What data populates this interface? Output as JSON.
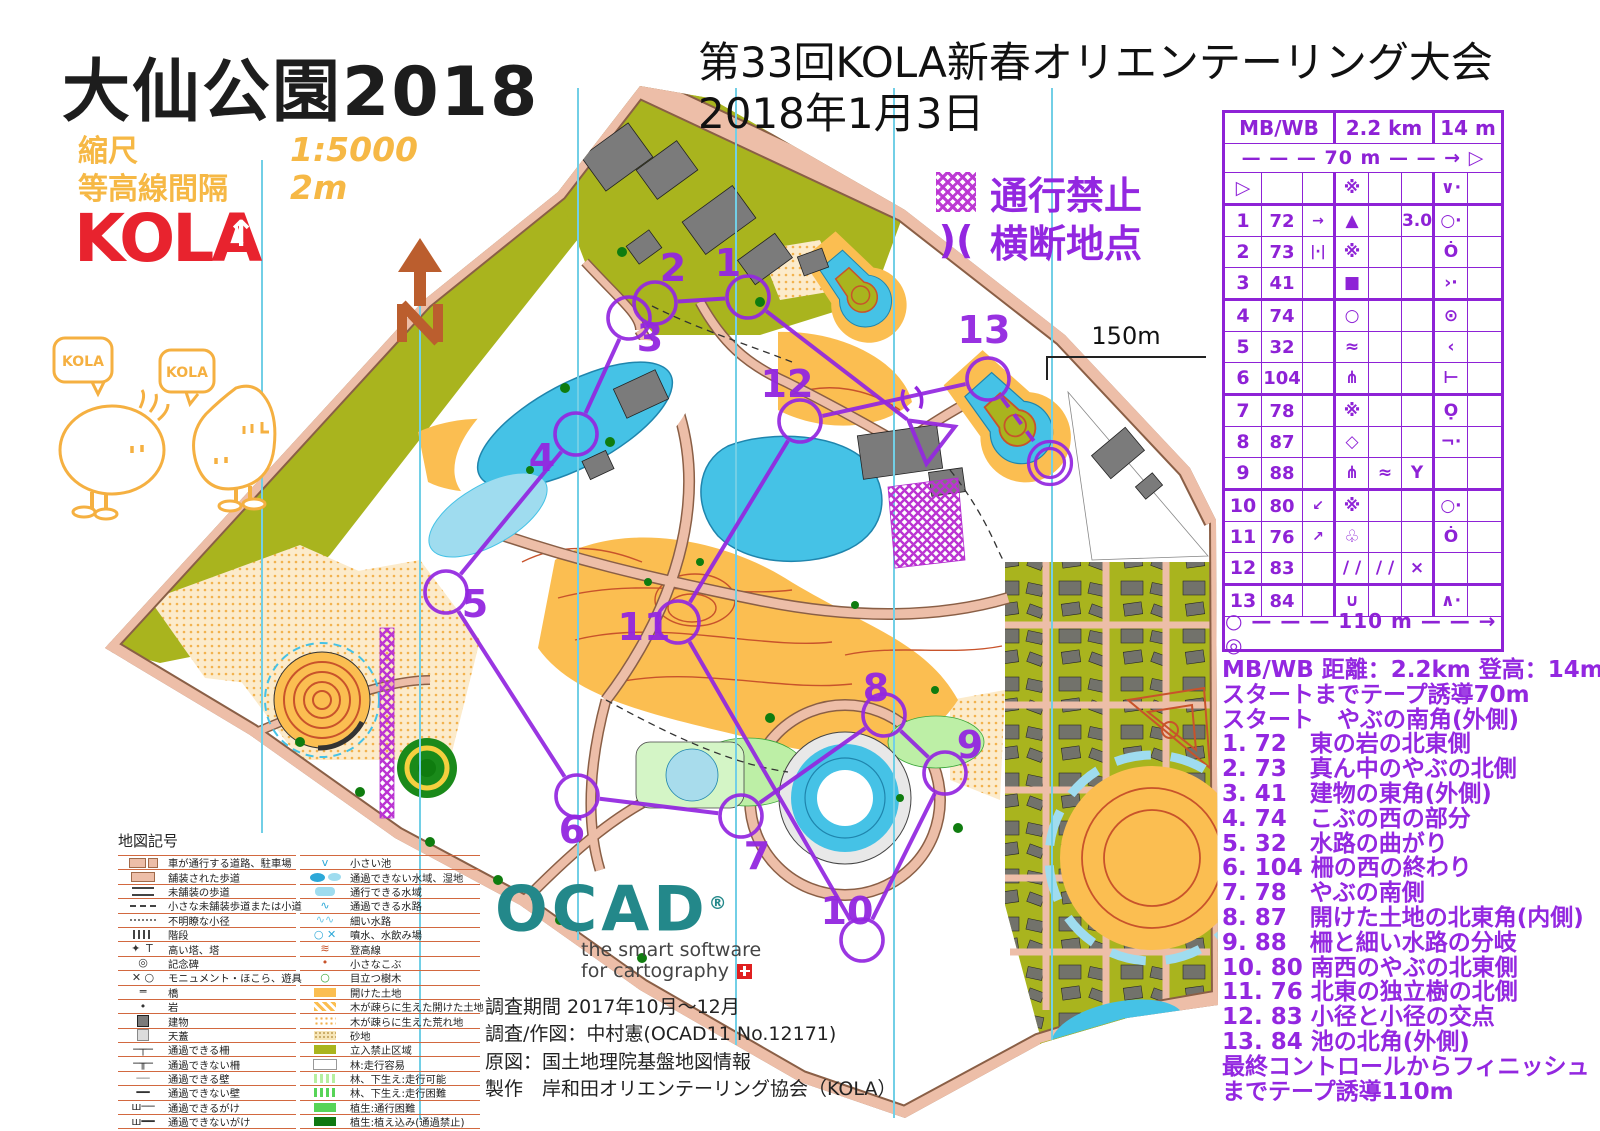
{
  "title_block": {
    "title": "大仙公園2018",
    "scale_label": "縮尺",
    "scale_value": "1:5000",
    "contour_label": "等高線間隔",
    "contour_value": "2m",
    "club": "KOLA"
  },
  "event": {
    "line1": "第33回KOLA新春オリエンテーリング大会",
    "line2": "2018年1月3日"
  },
  "overprint": {
    "forbidden_label": "通行禁止",
    "crossing_symbol": ")(",
    "crossing_label": "横断地点"
  },
  "mascots": {
    "left_bubble": "KOLA",
    "right_bubble": "KOLA"
  },
  "north_arrow": {
    "letter": "N"
  },
  "scale_bar": {
    "label": "150m"
  },
  "control_card": {
    "class_header": "MB/WB",
    "distance_header": "2.2 km",
    "climb_header": "14 m",
    "tape_to_start": "— — —  70 m  — — → ▷",
    "tape_to_finish": "○ — — —  110 m  — — → ◎",
    "start_row": {
      "a": "▷",
      "b": "",
      "c": "",
      "d": "※",
      "e": "",
      "f": "",
      "g": "∨·",
      "h": ""
    },
    "rows": [
      {
        "a": "1",
        "b": "72",
        "c": "→",
        "d": "▲",
        "e": "",
        "f": "3.0",
        "g": "○·",
        "h": ""
      },
      {
        "a": "2",
        "b": "73",
        "c": "|·|",
        "d": "※",
        "e": "",
        "f": "",
        "g": "Ȯ",
        "h": ""
      },
      {
        "a": "3",
        "b": "41",
        "c": "",
        "d": "■",
        "e": "",
        "f": "",
        "g": "›·",
        "h": ""
      },
      {
        "a": "4",
        "b": "74",
        "c": "",
        "d": "○",
        "e": "",
        "f": "",
        "g": "⊙",
        "h": ""
      },
      {
        "a": "5",
        "b": "32",
        "c": "",
        "d": "≈",
        "e": "",
        "f": "",
        "g": "‹",
        "h": ""
      },
      {
        "a": "6",
        "b": "104",
        "c": "",
        "d": "⋔",
        "e": "",
        "f": "",
        "g": "⊢",
        "h": ""
      },
      {
        "a": "7",
        "b": "78",
        "c": "",
        "d": "※",
        "e": "",
        "f": "",
        "g": "Ọ",
        "h": ""
      },
      {
        "a": "8",
        "b": "87",
        "c": "",
        "d": "◇",
        "e": "",
        "f": "",
        "g": "¬·",
        "h": ""
      },
      {
        "a": "9",
        "b": "88",
        "c": "",
        "d": "⋔",
        "e": "≈",
        "f": "Y",
        "g": "",
        "h": ""
      },
      {
        "a": "10",
        "b": "80",
        "c": "↙",
        "d": "※",
        "e": "",
        "f": "",
        "g": "○·",
        "h": ""
      },
      {
        "a": "11",
        "b": "76",
        "c": "↗",
        "d": "♧",
        "e": "",
        "f": "",
        "g": "Ȯ",
        "h": ""
      },
      {
        "a": "12",
        "b": "83",
        "c": "",
        "d": "∕ ∕",
        "e": "∕ ∕",
        "f": "×",
        "g": "",
        "h": ""
      },
      {
        "a": "13",
        "b": "84",
        "c": "",
        "d": "∪",
        "e": "",
        "f": "",
        "g": "∧·",
        "h": ""
      }
    ],
    "thick_after": [
      "▷",
      "3",
      "6",
      "9",
      "12"
    ]
  },
  "descriptions": {
    "lines": [
      "MB/WB 距離：2.2km 登高：14m",
      "スタートまでテープ誘導70m",
      "スタート　やぶの南角(外側)",
      "1. 72　東の岩の北東側",
      "2. 73　真ん中のやぶの北側",
      "3. 41　建物の東角(外側)",
      "4. 74　こぶの西の部分",
      "5. 32　水路の曲がり",
      "6. 104 柵の西の終わり",
      "7. 78　やぶの南側",
      "8. 87　開けた土地の北東角(内側)",
      "9. 88　柵と細い水路の分岐",
      "10. 80 南西のやぶの北東側",
      "11. 76 北東の独立樹の北側",
      "12. 83 小径と小径の交点",
      "13. 84 池の北角(外側)",
      "最終コントロールからフィニッシュ",
      "までテープ誘導110m"
    ]
  },
  "map_legend": {
    "title": "地図記号",
    "col1": [
      {
        "cls": "s-road",
        "label": "車が通行する道路、駐車場"
      },
      {
        "cls": "s-paved",
        "label": "舗装された歩道"
      },
      {
        "cls": "s-unpaved",
        "label": "未舗装の歩道"
      },
      {
        "cls": "s-smallpath",
        "label": "小さな未舗装歩道または小道"
      },
      {
        "cls": "s-indistinct",
        "label": "不明瞭な小径"
      },
      {
        "cls": "s-steps",
        "label": "階段"
      },
      {
        "cls": "glyph",
        "g": "✦ Ｔ",
        "label": "高い塔、塔"
      },
      {
        "cls": "glyph",
        "g": "◎",
        "label": "記念碑"
      },
      {
        "cls": "glyph",
        "g": "✕ ○",
        "label": "モニュメント・ほこら、遊具"
      },
      {
        "cls": "glyph",
        "g": "═",
        "label": "橋"
      },
      {
        "cls": "glyph",
        "g": "•",
        "label": "岩"
      },
      {
        "cls": "s-bld",
        "label": "建物"
      },
      {
        "cls": "s-canopy",
        "label": "天蓋"
      },
      {
        "cls": "glyph",
        "g": "─┬─",
        "label": "通過できる柵"
      },
      {
        "cls": "glyph",
        "g": "─╥─",
        "label": "通過できない柵"
      },
      {
        "cls": "glyph",
        "g": "──",
        "c": "#888",
        "label": "通過できる壁"
      },
      {
        "cls": "glyph",
        "g": "━━",
        "label": "通過できない壁"
      },
      {
        "cls": "glyph",
        "g": "ш──",
        "label": "通過できるがけ"
      },
      {
        "cls": "glyph",
        "g": "ш━━",
        "label": "通過できないがけ"
      },
      {
        "cls": "glyph",
        "g": "─+─",
        "label": "通過できる石塁"
      }
    ],
    "col2": [
      {
        "cls": "glyph",
        "g": "v",
        "c": "#2da8d8",
        "label": "小さい池"
      },
      {
        "cls": "s-waterimp",
        "label": "通過できない水域、湿地"
      },
      {
        "cls": "s-waterpass",
        "label": "通行できる水域"
      },
      {
        "cls": "glyph",
        "g": "∿",
        "c": "#2da8d8",
        "label": "通過できる水路"
      },
      {
        "cls": "glyph",
        "g": "∿∿",
        "c": "#6fc8e8",
        "label": "細い水路"
      },
      {
        "cls": "glyph",
        "g": "○ ✕",
        "c": "#2da8d8",
        "label": "噴水、水飲み場"
      },
      {
        "cls": "glyph",
        "g": "≋",
        "c": "#C8532B",
        "label": "登高線"
      },
      {
        "cls": "glyph",
        "g": "•",
        "c": "#C8532B",
        "label": "小さなこぶ"
      },
      {
        "cls": "glyph",
        "g": "○",
        "c": "#3aa53a",
        "label": "目立つ樹木"
      },
      {
        "cls": "s-openland",
        "label": "開けた土地"
      },
      {
        "cls": "s-openscat",
        "label": "木が疎らに生えた開けた土地"
      },
      {
        "cls": "s-roughscat",
        "label": "木が疎らに生えた荒れ地"
      },
      {
        "cls": "s-sand",
        "label": "砂地"
      },
      {
        "cls": "s-oob",
        "label": "立入禁止区域"
      },
      {
        "cls": "s-forest",
        "label": "林:走行容易"
      },
      {
        "cls": "s-ug-ok",
        "label": "林、下生え:走行可能"
      },
      {
        "cls": "s-ug-hard",
        "label": "林、下生え:走行困難"
      },
      {
        "cls": "s-veg-hard",
        "label": "植生:通行困難"
      },
      {
        "cls": "s-veg-no",
        "label": "植生:植え込み(通過禁止)"
      }
    ]
  },
  "credits": {
    "logo": "OCAD",
    "reg": "®",
    "tagline1": "the smart software",
    "tagline2": "for cartography",
    "lines": [
      "調査期間 2017年10月～12月",
      "調査/作図：中村憲(OCAD11 No.12171)",
      "原図：国土地理院基盤地図情報",
      "製作　岸和田オリエンテーリング協会（KOLA）"
    ]
  },
  "course": {
    "color": "#9327E0",
    "circle_radius": 21,
    "line_width": 4,
    "number_size": 38,
    "start": {
      "x": 930,
      "y": 437
    },
    "finish": {
      "x": 1050,
      "y": 463
    },
    "controls": [
      {
        "n": "1",
        "x": 748,
        "y": 297,
        "lx": 728,
        "ly": 263
      },
      {
        "n": "2",
        "x": 655,
        "y": 303,
        "lx": 673,
        "ly": 268
      },
      {
        "n": "3",
        "x": 629,
        "y": 318,
        "lx": 650,
        "ly": 338
      },
      {
        "n": "4",
        "x": 576,
        "y": 434,
        "lx": 542,
        "ly": 458
      },
      {
        "n": "5",
        "x": 446,
        "y": 592,
        "lx": 475,
        "ly": 604
      },
      {
        "n": "6",
        "x": 577,
        "y": 796,
        "lx": 572,
        "ly": 830
      },
      {
        "n": "7",
        "x": 741,
        "y": 816,
        "lx": 757,
        "ly": 856
      },
      {
        "n": "8",
        "x": 884,
        "y": 715,
        "lx": 876,
        "ly": 688
      },
      {
        "n": "9",
        "x": 945,
        "y": 773,
        "lx": 970,
        "ly": 745
      },
      {
        "n": "10",
        "x": 862,
        "y": 940,
        "lx": 847,
        "ly": 911
      },
      {
        "n": "11",
        "x": 678,
        "y": 622,
        "lx": 644,
        "ly": 627
      },
      {
        "n": "12",
        "x": 800,
        "y": 421,
        "lx": 787,
        "ly": 384
      },
      {
        "n": "13",
        "x": 988,
        "y": 379,
        "lx": 984,
        "ly": 330
      }
    ],
    "crossings": [
      {
        "x": 912,
        "y": 399,
        "rot": -13
      }
    ],
    "forbidden_zones": [
      [
        888,
        487,
        958,
        478,
        965,
        560,
        895,
        568
      ],
      [
        380,
        628,
        394,
        628,
        394,
        818,
        380,
        818
      ]
    ]
  }
}
